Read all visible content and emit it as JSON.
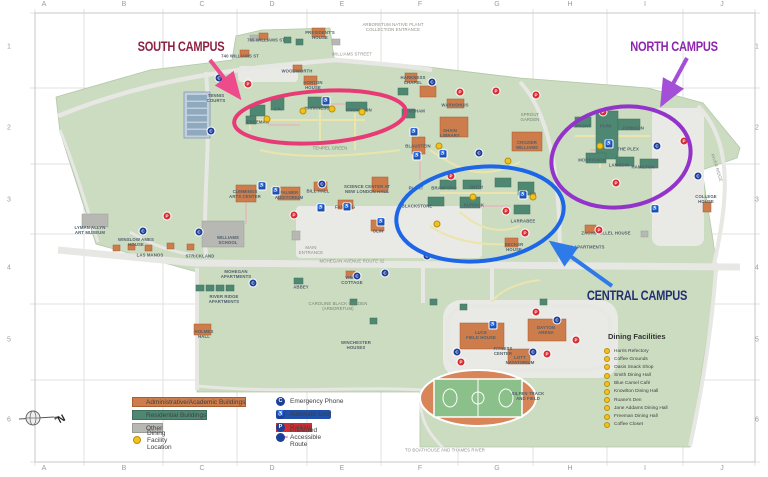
{
  "colors": {
    "land": "#cbdcc1",
    "road": "#e7e7e3",
    "academic": "#cd7c4b",
    "residential": "#4f8872",
    "other": "#b7b7b3",
    "south_ellipse": "#e83a74",
    "north_ellipse": "#9333c9",
    "central_ellipse": "#1d66e8",
    "emergency_phone": "#1d3f98",
    "automatic_door": "#2050a8",
    "parking": "#d62d33",
    "dining_dot": "#f2c21c"
  },
  "grid": {
    "cols": [
      {
        "t": "A",
        "x": 44
      },
      {
        "t": "B",
        "x": 124
      },
      {
        "t": "C",
        "x": 202
      },
      {
        "t": "D",
        "x": 272
      },
      {
        "t": "E",
        "x": 342
      },
      {
        "t": "F",
        "x": 420
      },
      {
        "t": "G",
        "x": 497
      },
      {
        "t": "H",
        "x": 570
      },
      {
        "t": "I",
        "x": 645
      },
      {
        "t": "J",
        "x": 722
      }
    ],
    "rows": [
      {
        "t": "1",
        "y": 47
      },
      {
        "t": "2",
        "y": 128
      },
      {
        "t": "3",
        "y": 200
      },
      {
        "t": "4",
        "y": 268
      },
      {
        "t": "5",
        "y": 340
      },
      {
        "t": "6",
        "y": 420
      }
    ]
  },
  "campus_labels": [
    {
      "t": "SOUTH CAMPUS",
      "x": 181,
      "y": 47,
      "color": "#8e2443"
    },
    {
      "t": "NORTH CAMPUS",
      "x": 674,
      "y": 47,
      "color": "#8c26ad"
    },
    {
      "t": "CENTRAL CAMPUS",
      "x": 637,
      "y": 296,
      "color": "#252f6f"
    }
  ],
  "map_labels": [
    {
      "t": "765 WILLIAMS ST",
      "x": 266,
      "y": 41
    },
    {
      "t": "PRESIDENT'S\nHOUSE",
      "x": 320,
      "y": 36
    },
    {
      "t": "740 WILLIAMS ST",
      "x": 240,
      "y": 57
    },
    {
      "t": "WILLIAMS STREET",
      "x": 352,
      "y": 55,
      "cls": "road"
    },
    {
      "t": "ARBORETUM NATIVE PLANT\nCOLLECTION ENTRANCE",
      "x": 393,
      "y": 28,
      "cls": "road"
    },
    {
      "t": "WOODWORTH",
      "x": 297,
      "y": 72
    },
    {
      "t": "HORTON\nHOUSE",
      "x": 313,
      "y": 86
    },
    {
      "t": "TENNIS\nCOURTS",
      "x": 216,
      "y": 99
    },
    {
      "t": "FREEMAN",
      "x": 258,
      "y": 123
    },
    {
      "t": "J.A.",
      "x": 278,
      "y": 110
    },
    {
      "t": "HARKNESS",
      "x": 317,
      "y": 109
    },
    {
      "t": "KNOWLTON",
      "x": 359,
      "y": 111
    },
    {
      "t": "TEMPEL GREEN",
      "x": 330,
      "y": 149,
      "cls": "area"
    },
    {
      "t": "HARKNESS\nCHAPEL",
      "x": 413,
      "y": 81
    },
    {
      "t": "WARNSHUIS",
      "x": 455,
      "y": 106
    },
    {
      "t": "WINDHAM",
      "x": 414,
      "y": 112
    },
    {
      "t": "SHAIN\nLIBRARY",
      "x": 450,
      "y": 134
    },
    {
      "t": "BLAUSTEIN",
      "x": 418,
      "y": 147
    },
    {
      "t": "SPROUT\nGARDEN",
      "x": 530,
      "y": 118,
      "cls": "area"
    },
    {
      "t": "CROZIER\nWILLIAMS",
      "x": 527,
      "y": 146
    },
    {
      "t": "LYMAN ALLYN\nART MUSEUM",
      "x": 90,
      "y": 231
    },
    {
      "t": "WILLIAMS\nSCHOOL",
      "x": 228,
      "y": 241
    },
    {
      "t": "WINSLOW AMES\nHOUSE",
      "x": 136,
      "y": 243
    },
    {
      "t": "LAS MANOS",
      "x": 150,
      "y": 256
    },
    {
      "t": "STRICKLAND",
      "x": 200,
      "y": 257
    },
    {
      "t": "CUMMINGS\nARTS CENTER",
      "x": 245,
      "y": 195
    },
    {
      "t": "PALMER\nAUDITORIUM",
      "x": 289,
      "y": 196
    },
    {
      "t": "BILL HALL",
      "x": 318,
      "y": 192
    },
    {
      "t": "FANNING",
      "x": 345,
      "y": 208
    },
    {
      "t": "SCIENCE CENTER AT\nNEW LONDON HALL",
      "x": 367,
      "y": 190
    },
    {
      "t": "OLIN",
      "x": 378,
      "y": 232
    },
    {
      "t": "PLANT",
      "x": 416,
      "y": 189
    },
    {
      "t": "BRANFORD",
      "x": 444,
      "y": 189
    },
    {
      "t": "SMITH",
      "x": 476,
      "y": 188
    },
    {
      "t": "BURDICK",
      "x": 474,
      "y": 206
    },
    {
      "t": "BLACKSTONE",
      "x": 417,
      "y": 207
    },
    {
      "t": "KB",
      "x": 533,
      "y": 195
    },
    {
      "t": "LARRABEE",
      "x": 523,
      "y": 222
    },
    {
      "t": "BECKER\nHOUSE",
      "x": 514,
      "y": 248
    },
    {
      "t": "ZACHS HILLEL HOUSE",
      "x": 606,
      "y": 234
    },
    {
      "t": "360 APARTMENTS",
      "x": 585,
      "y": 248
    },
    {
      "t": "WRIGHT",
      "x": 582,
      "y": 127
    },
    {
      "t": "PARK",
      "x": 606,
      "y": 127
    },
    {
      "t": "JOHNSON",
      "x": 633,
      "y": 129
    },
    {
      "t": "THE PLEX",
      "x": 628,
      "y": 150
    },
    {
      "t": "MORRISSON",
      "x": 592,
      "y": 161
    },
    {
      "t": "LAMBDIN",
      "x": 619,
      "y": 166
    },
    {
      "t": "HAMILTON",
      "x": 643,
      "y": 168
    },
    {
      "t": "COLLEGE\nHOUSE",
      "x": 706,
      "y": 200
    },
    {
      "t": "MAIN\nENTRANCE",
      "x": 311,
      "y": 251,
      "cls": "road"
    },
    {
      "t": "MOHEGAN AVENUE ROUTE 32",
      "x": 352,
      "y": 262,
      "cls": "road"
    },
    {
      "t": "MOHEGAN\nAPARTMENTS",
      "x": 236,
      "y": 275
    },
    {
      "t": "RIVER RIDGE\nAPARTMENTS",
      "x": 224,
      "y": 300
    },
    {
      "t": "ABBEY",
      "x": 301,
      "y": 288
    },
    {
      "t": "VINAL\nCOTTAGE",
      "x": 352,
      "y": 281
    },
    {
      "t": "CAROLINE BLACK GARDEN\n(ARBORETUM)",
      "x": 338,
      "y": 307,
      "cls": "area"
    },
    {
      "t": "WINCHESTER\nHOUSES",
      "x": 356,
      "y": 346
    },
    {
      "t": "HOLMES\nHALL",
      "x": 204,
      "y": 335
    },
    {
      "t": "LUCE\nFIELD HOUSE",
      "x": 481,
      "y": 336
    },
    {
      "t": "DAYTON\nARENA",
      "x": 546,
      "y": 331
    },
    {
      "t": "FITNESS\nCENTER",
      "x": 503,
      "y": 352
    },
    {
      "t": "LOTT\nNATATORIUM",
      "x": 520,
      "y": 361
    },
    {
      "t": "SILFEN TRACK\nAND FIELD",
      "x": 528,
      "y": 397
    },
    {
      "t": "TO BOATHOUSE AND THAMES RIVER",
      "x": 445,
      "y": 451,
      "cls": "road"
    },
    {
      "t": "RIVER RIDGE",
      "x": 716,
      "y": 168,
      "cls": "rot road"
    }
  ],
  "pois": [
    {
      "cls": "ep",
      "g": "C",
      "x": 219,
      "y": 78
    },
    {
      "cls": "ep",
      "g": "C",
      "x": 211,
      "y": 131
    },
    {
      "cls": "ep",
      "g": "C",
      "x": 143,
      "y": 231
    },
    {
      "cls": "ep",
      "g": "C",
      "x": 199,
      "y": 232
    },
    {
      "cls": "ep",
      "g": "C",
      "x": 322,
      "y": 184
    },
    {
      "cls": "ep",
      "g": "C",
      "x": 427,
      "y": 256
    },
    {
      "cls": "ep",
      "g": "C",
      "x": 432,
      "y": 82
    },
    {
      "cls": "ep",
      "g": "C",
      "x": 479,
      "y": 153
    },
    {
      "cls": "ep",
      "g": "C",
      "x": 657,
      "y": 146
    },
    {
      "cls": "ep",
      "g": "C",
      "x": 698,
      "y": 176
    },
    {
      "cls": "ep",
      "g": "C",
      "x": 253,
      "y": 283
    },
    {
      "cls": "ep",
      "g": "C",
      "x": 357,
      "y": 276
    },
    {
      "cls": "ep",
      "g": "C",
      "x": 385,
      "y": 273
    },
    {
      "cls": "ep",
      "g": "C",
      "x": 457,
      "y": 352
    },
    {
      "cls": "ep",
      "g": "C",
      "x": 533,
      "y": 352
    },
    {
      "cls": "ep",
      "g": "C",
      "x": 557,
      "y": 320
    },
    {
      "cls": "ad",
      "g": "♿",
      "x": 326,
      "y": 101
    },
    {
      "cls": "ad",
      "g": "♿",
      "x": 262,
      "y": 186
    },
    {
      "cls": "ad",
      "g": "♿",
      "x": 276,
      "y": 191
    },
    {
      "cls": "ad",
      "g": "♿",
      "x": 321,
      "y": 208
    },
    {
      "cls": "ad",
      "g": "♿",
      "x": 414,
      "y": 132
    },
    {
      "cls": "ad",
      "g": "♿",
      "x": 417,
      "y": 156
    },
    {
      "cls": "ad",
      "g": "♿",
      "x": 443,
      "y": 154
    },
    {
      "cls": "ad",
      "g": "♿",
      "x": 523,
      "y": 195
    },
    {
      "cls": "ad",
      "g": "♿",
      "x": 381,
      "y": 222
    },
    {
      "cls": "ad",
      "g": "♿",
      "x": 347,
      "y": 207
    },
    {
      "cls": "ad",
      "g": "♿",
      "x": 609,
      "y": 144
    },
    {
      "cls": "ad",
      "g": "♿",
      "x": 655,
      "y": 209
    },
    {
      "cls": "ad",
      "g": "♿",
      "x": 493,
      "y": 325
    },
    {
      "cls": "pk",
      "g": "P",
      "x": 248,
      "y": 84
    },
    {
      "cls": "pk",
      "g": "P",
      "x": 167,
      "y": 216
    },
    {
      "cls": "pk",
      "g": "P",
      "x": 294,
      "y": 215
    },
    {
      "cls": "pk",
      "g": "P",
      "x": 460,
      "y": 92
    },
    {
      "cls": "pk",
      "g": "P",
      "x": 496,
      "y": 91
    },
    {
      "cls": "pk",
      "g": "P",
      "x": 536,
      "y": 95
    },
    {
      "cls": "pk",
      "g": "P",
      "x": 451,
      "y": 176
    },
    {
      "cls": "pk",
      "g": "P",
      "x": 506,
      "y": 211
    },
    {
      "cls": "pk",
      "g": "P",
      "x": 603,
      "y": 112
    },
    {
      "cls": "pk",
      "g": "P",
      "x": 616,
      "y": 183
    },
    {
      "cls": "pk",
      "g": "P",
      "x": 684,
      "y": 141
    },
    {
      "cls": "pk",
      "g": "P",
      "x": 525,
      "y": 233
    },
    {
      "cls": "pk",
      "g": "P",
      "x": 599,
      "y": 230
    },
    {
      "cls": "pk",
      "g": "P",
      "x": 536,
      "y": 312
    },
    {
      "cls": "pk",
      "g": "P",
      "x": 576,
      "y": 340
    },
    {
      "cls": "pk",
      "g": "P",
      "x": 547,
      "y": 354
    },
    {
      "cls": "pk",
      "g": "P",
      "x": 461,
      "y": 362
    },
    {
      "cls": "dn",
      "g": "",
      "x": 267,
      "y": 119
    },
    {
      "cls": "dn",
      "g": "",
      "x": 303,
      "y": 111
    },
    {
      "cls": "dn",
      "g": "",
      "x": 332,
      "y": 109
    },
    {
      "cls": "dn",
      "g": "",
      "x": 362,
      "y": 112
    },
    {
      "cls": "dn",
      "g": "",
      "x": 473,
      "y": 197
    },
    {
      "cls": "dn",
      "g": "",
      "x": 533,
      "y": 197
    },
    {
      "cls": "dn",
      "g": "",
      "x": 439,
      "y": 146
    },
    {
      "cls": "dn",
      "g": "",
      "x": 508,
      "y": 161
    },
    {
      "cls": "dn",
      "g": "",
      "x": 600,
      "y": 146
    },
    {
      "cls": "dn",
      "g": "",
      "x": 437,
      "y": 224
    }
  ],
  "legend": {
    "building_types": [
      {
        "t": "Administrative/Academic Buildings",
        "cls": "sw-orange",
        "x": 132,
        "y": 397
      },
      {
        "t": "Residential Buildings",
        "cls": "sw-green",
        "x": 132,
        "y": 410
      },
      {
        "t": "Other",
        "cls": "sw-gray",
        "x": 132,
        "y": 423
      },
      {
        "t": "Dining Facility Location",
        "cls": "sw-dot",
        "x": 132,
        "y": 436
      }
    ],
    "symbols": [
      {
        "t": "Emergency Phone",
        "cls": "",
        "g": "C",
        "x": 276,
        "y": 397
      },
      {
        "t": "Automatic Door",
        "cls": "sym-ad",
        "g": "♿",
        "x": 276,
        "y": 410
      },
      {
        "t": "Parking",
        "cls": "sym-pk",
        "g": "P",
        "x": 276,
        "y": 423
      },
      {
        "t": "Preferred Accessible Route",
        "cls": "sym-route",
        "g": "",
        "x": 276,
        "y": 436
      }
    ]
  },
  "dining": {
    "title": "Dining Facilities",
    "items": [
      {
        "t": "Harris Refectory"
      },
      {
        "t": "Coffee Grounds"
      },
      {
        "t": "Oasis Snack Shop"
      },
      {
        "t": "Smith Dining Hall"
      },
      {
        "t": "Blue Camel Café"
      },
      {
        "t": "Knowlton Dining Hall"
      },
      {
        "t": "Ruane's Den"
      },
      {
        "t": "Jane Addams Dining Hall"
      },
      {
        "t": "Freeman Dining Hall"
      },
      {
        "t": "Coffee Closet"
      }
    ]
  },
  "compass": {
    "label": "N"
  }
}
